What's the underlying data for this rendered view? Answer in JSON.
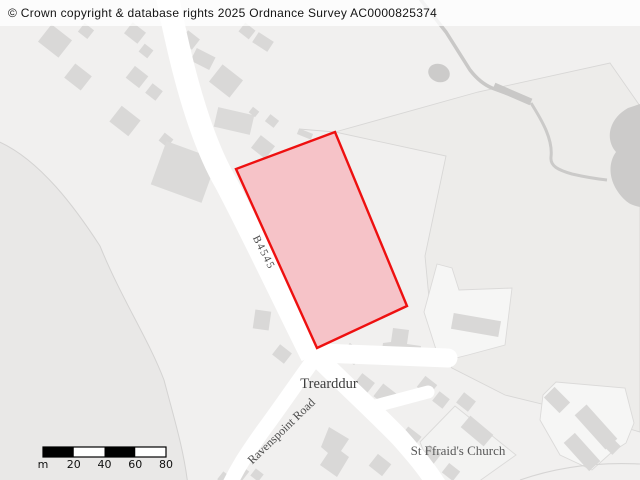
{
  "copyright": {
    "text": "© Crown copyright & database rights 2025 Ordnance Survey AC0000825374"
  },
  "labels": {
    "b4545": "B4545",
    "place": "Trearddur",
    "ravenspoint": "Ravenspoint Road",
    "church": "St Ffraid's Church"
  },
  "parcel": {
    "points": "335,132 236,169 317,348 407,306",
    "fill": "#f6c3c8",
    "stroke": "#ee1010",
    "stroke_width": "2.4"
  },
  "scale": {
    "unit": "m",
    "ticks": [
      "20",
      "40",
      "60",
      "80"
    ],
    "segment_metres": 20,
    "total_metres": 80
  },
  "colors": {
    "background": "#f1f0ef",
    "building": "#d9d8d7",
    "road": "#ffffff",
    "parcel_fill": "#f6c3c8",
    "parcel_stroke": "#ee1010",
    "label_text": "#4d4d4d"
  }
}
